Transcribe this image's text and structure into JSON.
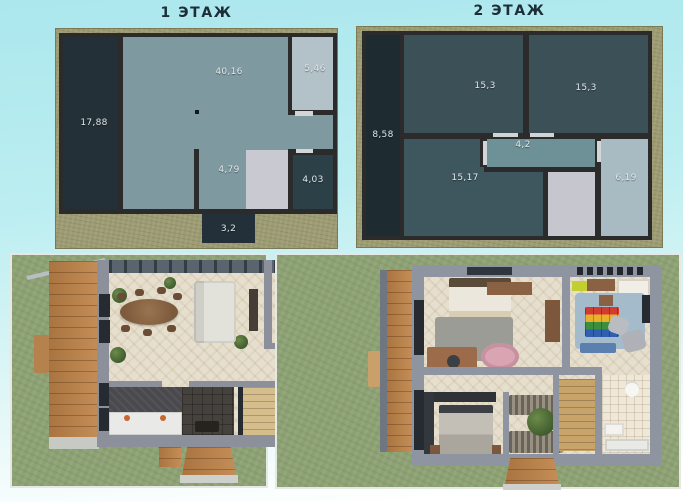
{
  "floors": {
    "floor1": {
      "title": "1 ЭТАЖ",
      "areas": {
        "terrace": "17,88",
        "living_kitchen": "40,16",
        "pantry": "5,46",
        "hall": "4,79",
        "bathroom": "4,03",
        "porch": "3,2"
      }
    },
    "floor2": {
      "title": "2 ЭТАЖ",
      "areas": {
        "balcony": "8,58",
        "bedroom_left": "15,3",
        "bedroom_right": "15,3",
        "hall": "4,2",
        "bedroom_bottom": "15,17",
        "bathroom": "6,19"
      }
    }
  },
  "colors": {
    "background_top": "#abe7ed",
    "plan_ground": "#9c9b72",
    "plan_wall": "#2b2b2b",
    "room_dark": "#233037",
    "room_teal": "#7f99a1",
    "room_light": "#b3c1c8",
    "room_dark_teal_2": "#3c5058",
    "stairs_light": "#c9c9d1",
    "door_gap": "#d2d6d8",
    "label_text": "#e2e9ec",
    "render_grass": "#8da274",
    "render_wall": "#8b909b",
    "render_floor": "#e7dfce",
    "render_wood": "#c08449"
  }
}
